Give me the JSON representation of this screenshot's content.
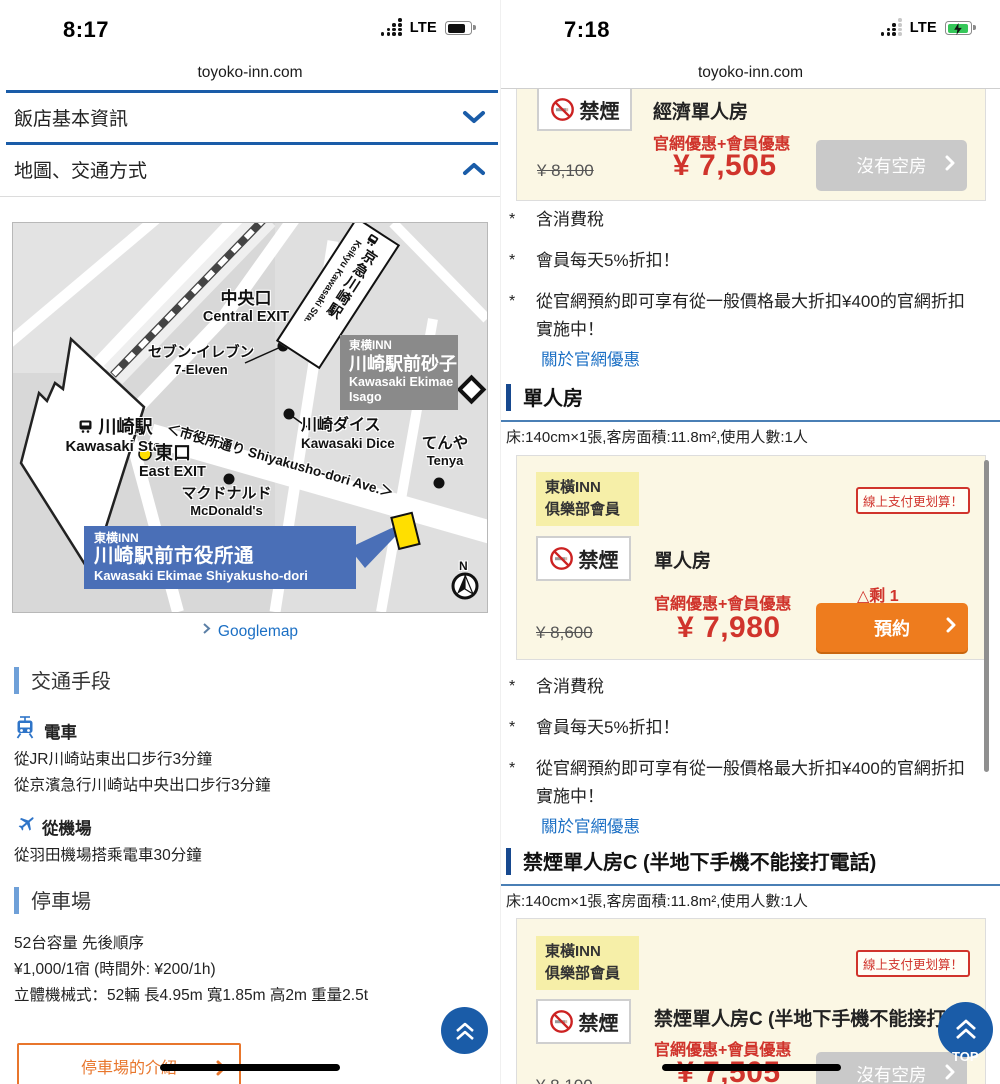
{
  "left": {
    "time": "8:17",
    "network": "LTE",
    "url": "toyoko-inn.com",
    "accordion": [
      {
        "label": "飯店基本資訊"
      },
      {
        "label": "地圖、交通方式"
      }
    ],
    "map": {
      "central_exit_jp": "中央口",
      "central_exit_en": "Central EXIT",
      "seven_eleven_jp": "セブン-イレブン",
      "seven_eleven_en": "7-Eleven",
      "keikyu_jp": "京急川崎駅",
      "keikyu_en": "Keikyu Kawasaki Sta.",
      "isago_line1": "東横INN",
      "isago_line2": "川崎駅前砂子",
      "isago_line3": "Kawasaki Ekimae",
      "isago_line4": "Isago",
      "kawasaki_jp": "川崎駅",
      "kawasaki_en": "Kawasaki Sta.",
      "east_exit_jp": "東口",
      "east_exit_en": "East EXIT",
      "dice_jp": "川崎ダイス",
      "dice_en": "Kawasaki Dice",
      "tenya_jp": "てんや",
      "tenya_en": "Tenya",
      "street": "＜市役所通り Shiyakusho-dori Ave.＞",
      "mcdonalds_jp": "マクドナルド",
      "mcdonalds_en": "McDonald's",
      "hotel_line1": "東横INN",
      "hotel_line2": "川崎駅前市役所通",
      "hotel_line3": "Kawasaki Ekimae Shiyakusho-dori",
      "compass": "N"
    },
    "googlemap_link": "Googlemap",
    "transport_title": "交通手段",
    "train_title": "電車",
    "train_line1": "從JR川崎站東出口步行3分鐘",
    "train_line2": "從京濱急行川崎站中央出口步行3分鐘",
    "airport_title": "從機場",
    "airport_line1": "從羽田機場搭乘電車30分鐘",
    "parking_title": "停車場",
    "parking_line1": "52台容量 先後順序",
    "parking_line2": "¥1,000/1宿 (時間外: ¥200/1h)",
    "parking_line3": "立體機械式：52輛 長4.95m 寬1.85m 高2m 重量2.5t",
    "parking_button": "停車場的介紹"
  },
  "right": {
    "time": "7:18",
    "network": "LTE",
    "url": "toyoko-inn.com",
    "member_badge_line1": "東橫INN",
    "member_badge_line2": "俱樂部會員",
    "online_pay_badge": "線上支付更划算！",
    "no_smoking": "禁煙",
    "promo": "官網優惠+會員優惠",
    "sold_out": "沒有空房",
    "reserve": "預約",
    "remaining": "△剩 1",
    "note_marker": "*",
    "notes": [
      "含消費稅",
      "會員每天5%折扣！",
      "從官網預約即可享有從一般價格最大折扣¥400的官網折扣實施中！"
    ],
    "about_link": "關於官網優惠",
    "room_spec": "床:140cm×1張,客房面積:11.8m²,使用人數:1人",
    "cards": [
      {
        "room": "經濟單人房",
        "old_price": "¥ 8,100",
        "price": "¥ 7,505"
      },
      {
        "room": "單人房",
        "old_price": "¥ 8,600",
        "price": "¥ 7,980"
      },
      {
        "room": "禁煙單人房C (半地下手機不能接打電話)",
        "old_price": "¥ 8,100",
        "price": "¥ 7,505"
      }
    ],
    "section_titles": [
      "單人房",
      "禁煙單人房C (半地下手機不能接打電話)"
    ],
    "back_to_top": "TOP"
  },
  "colors": {
    "accent_blue": "#1A5CA8",
    "link_blue": "#1B6FC4",
    "price_red": "#D0342C",
    "button_orange": "#EE7C1E",
    "card_cream": "#FBF7E4",
    "member_yellow": "#F6EFA8",
    "disabled_gray": "#C9C9C9",
    "map_callout_blue": "#4A6FB7",
    "marker_yellow": "#FFDF00"
  }
}
